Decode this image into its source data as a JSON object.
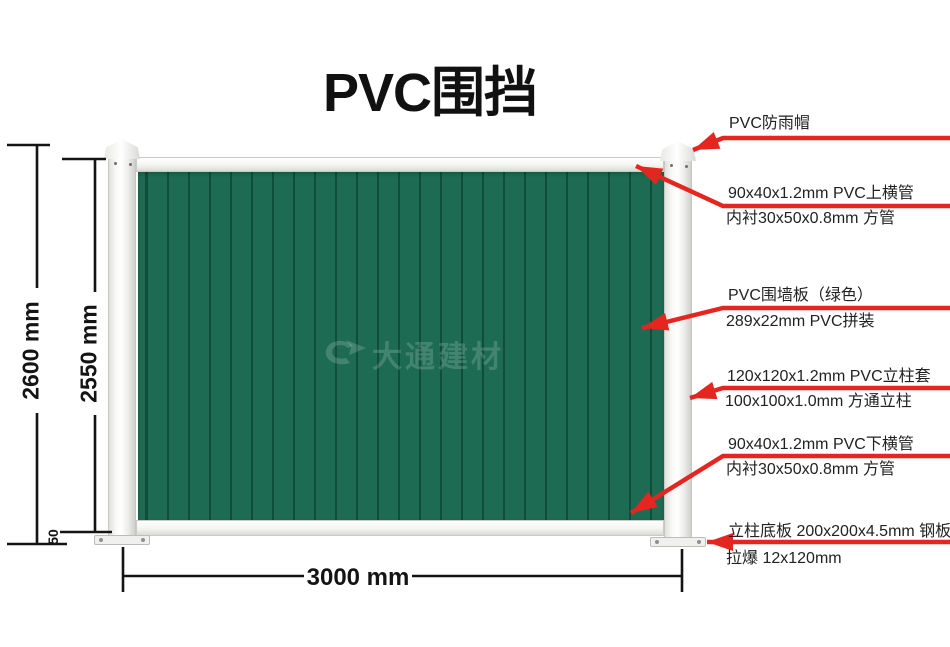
{
  "title": "PVC围挡",
  "watermark": {
    "text": "大通建材"
  },
  "dimensions": {
    "height_outer": "2600 mm",
    "height_inner": "2550 mm",
    "ground_gap": "50",
    "width": "3000 mm"
  },
  "callouts": [
    {
      "line1": "PVC防雨帽"
    },
    {
      "line1": "90x40x1.2mm PVC上横管",
      "line2": "内衬30x50x0.8mm 方管"
    },
    {
      "line1": "PVC围墙板（绿色）",
      "line2": "289x22mm PVC拼装"
    },
    {
      "line1": "120x120x1.2mm PVC立柱套",
      "line2": "100x100x1.0mm 方通立柱"
    },
    {
      "line1": "90x40x1.2mm PVC下横管",
      "line2": "内衬30x50x0.8mm 方管"
    },
    {
      "line1": "立柱底板 200x200x4.5mm 钢板",
      "line2": "拉爆 12x120mm"
    }
  ],
  "colors": {
    "accent_red": "#e52620",
    "panel_green": "#1e6b53",
    "panel_seam": "#093d2d",
    "dimension_line": "#141414"
  }
}
